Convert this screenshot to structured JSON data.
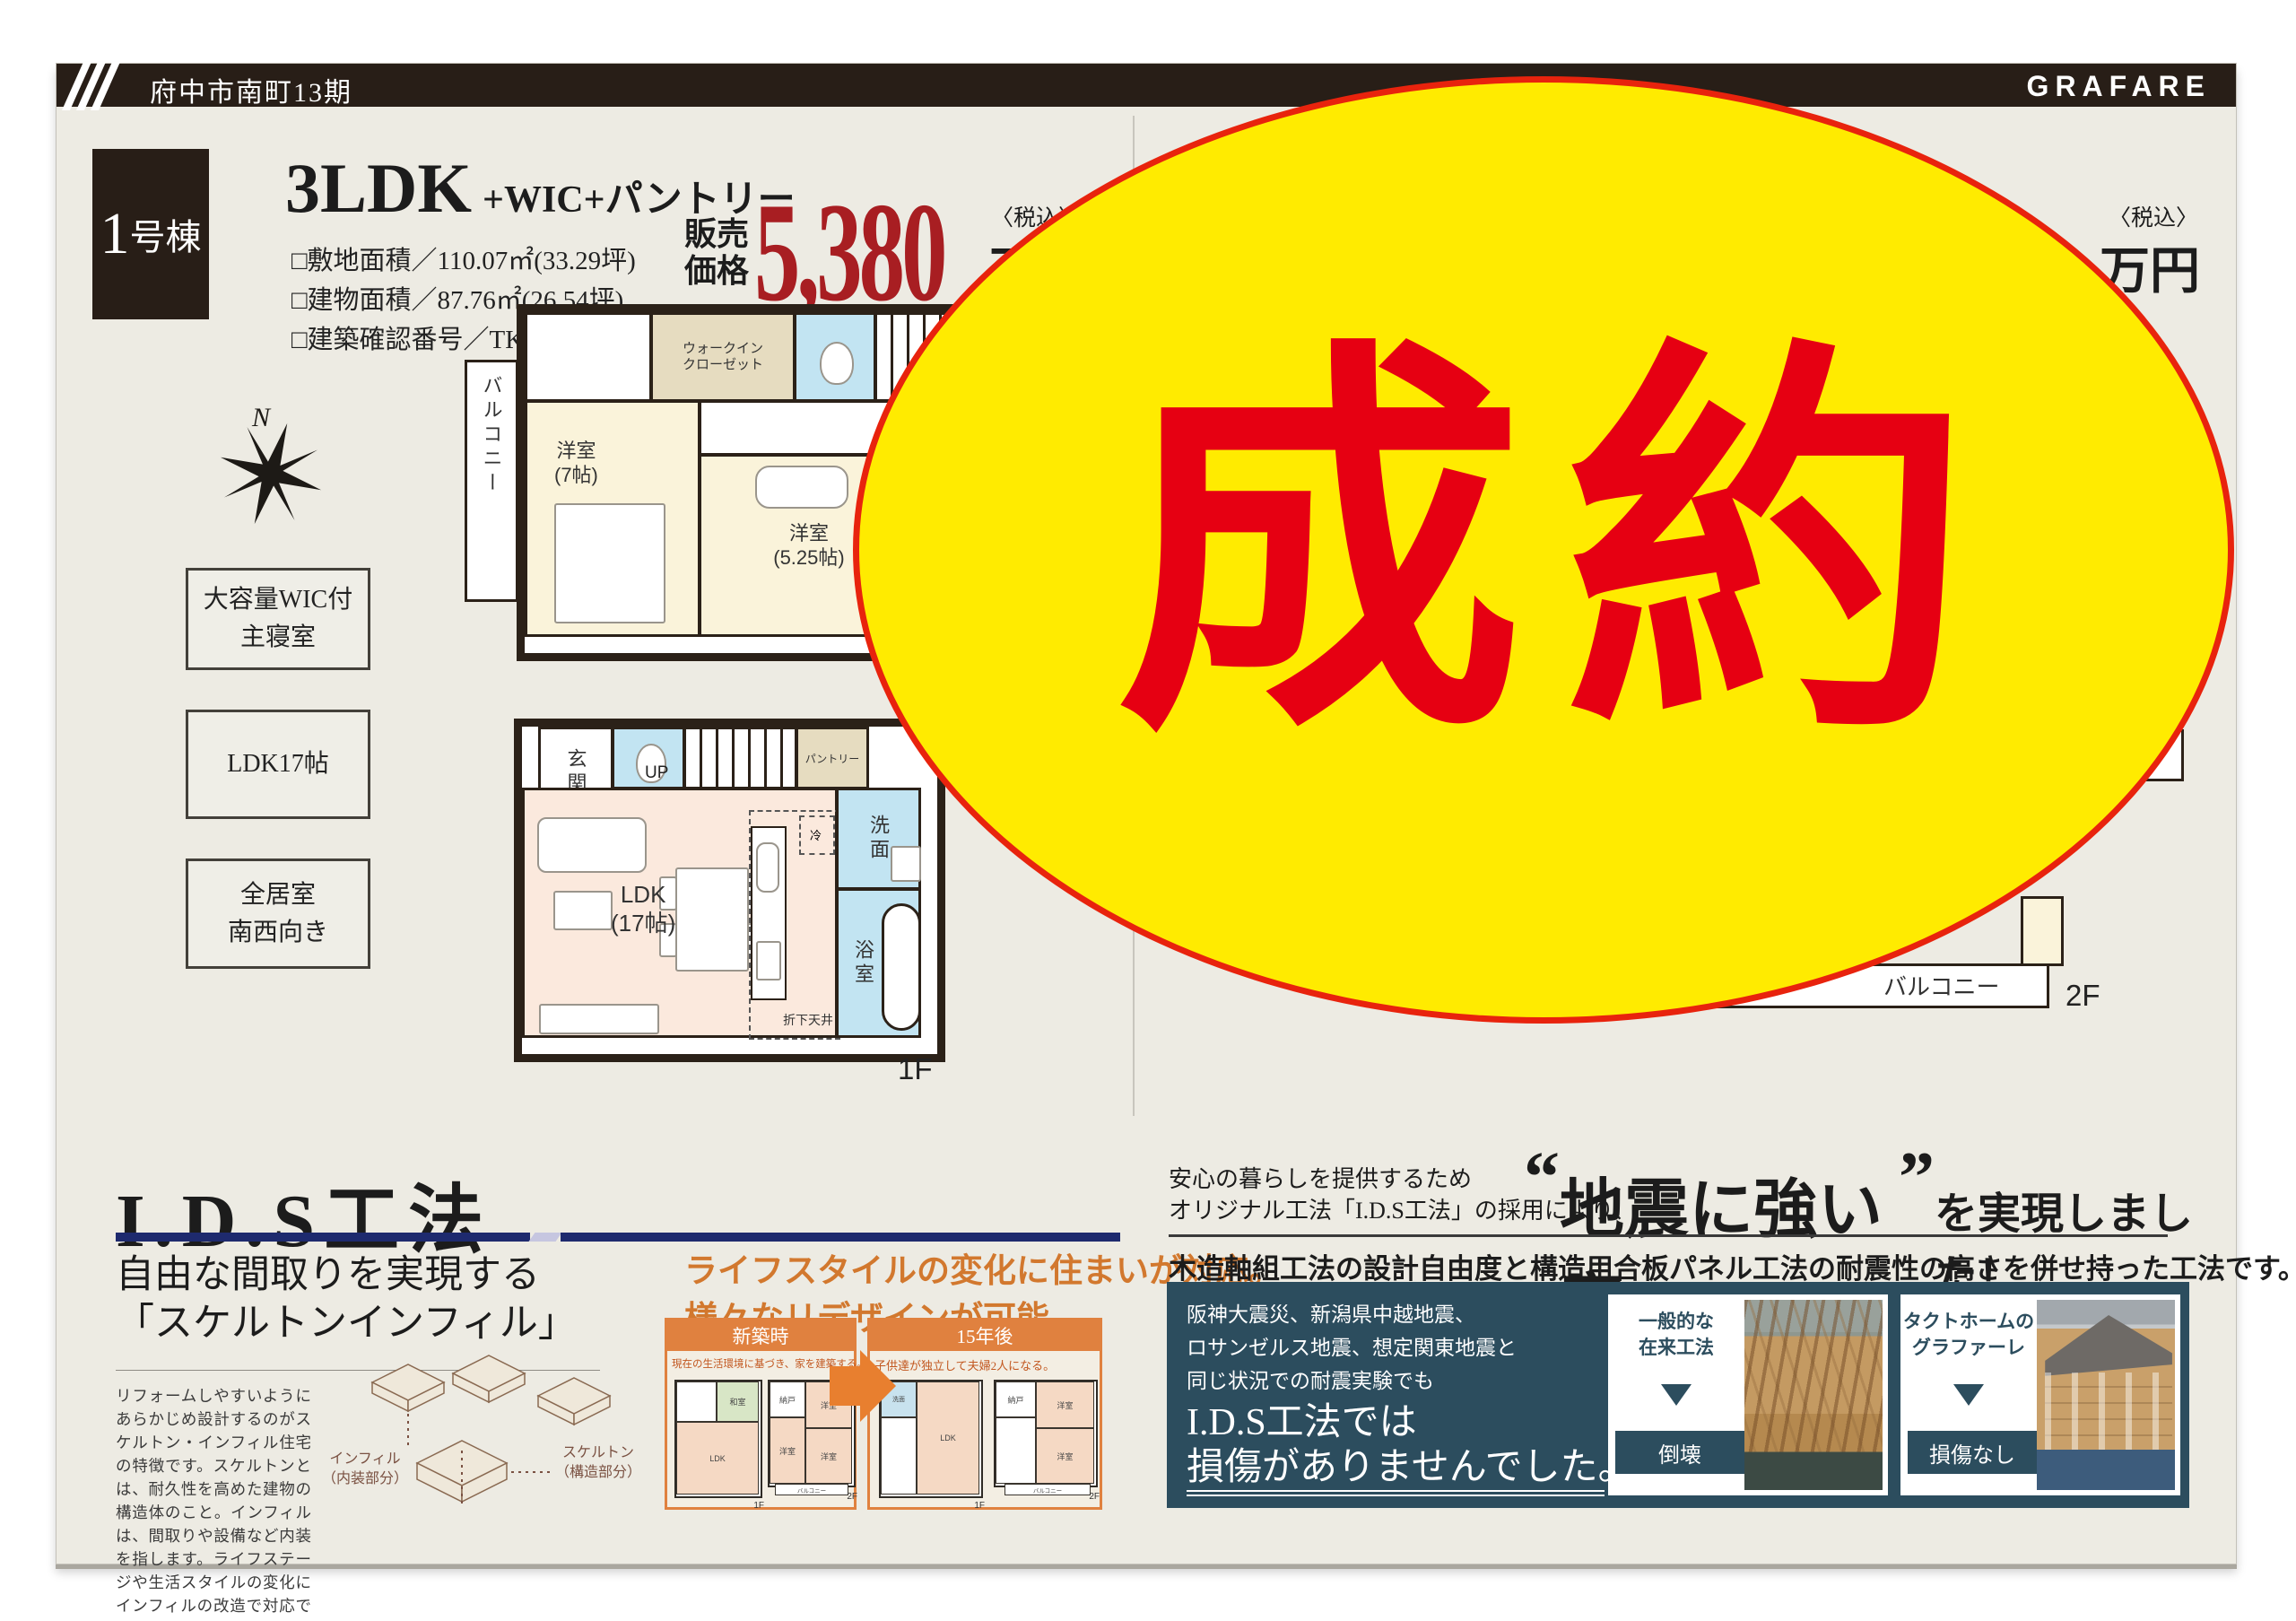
{
  "header": {
    "project": "府中市南町13期",
    "brand": "GRAFARE"
  },
  "unit1": {
    "badge_num": "1",
    "badge_suffix": "号棟",
    "plan": "3LDK",
    "plan_suffix": "+WIC+パントリー",
    "specs": [
      "□敷地面積／110.07㎡(33.29坪)",
      "□建物面積／87.76㎡(26.54坪)",
      "□建築確認番号／TKK確済25-244号"
    ],
    "price": {
      "label1": "販売",
      "label2": "価格",
      "value": "5,380",
      "tax": "〈税込〉",
      "unit": "万円"
    },
    "features": [
      {
        "l1": "大容量WIC付",
        "l2": "主寝室"
      },
      {
        "l1": "LDK17帖",
        "l2": ""
      },
      {
        "l1": "全居室",
        "l2": "南西向き"
      }
    ],
    "compass_n": "N",
    "f2": {
      "wic1": "ウォークイン",
      "wic2": "クローゼット",
      "balcony": "バルコニー",
      "r1a": "洋室",
      "r1b": "(7帖)",
      "r2a": "洋室",
      "r2b": "(5.25帖)",
      "r3a": "洋室",
      "r3b": "(4.5帖)",
      "dn": "DN",
      "floor": "2F"
    },
    "f1": {
      "genkan": "玄関",
      "up": "UP",
      "pantry": "パントリー",
      "ldk1": "LDK",
      "ldk2": "(17帖)",
      "wash": "洗面",
      "bath": "浴室",
      "ceiling": "折下天井",
      "fridge": "冷",
      "floor": "1F"
    }
  },
  "unit3": {
    "badge_num": "3",
    "badge_suffix": "号棟",
    "plan": "3LDK",
    "plan_suffix": "+WIC×2+",
    "specs": [
      "□敷地面積／109.97㎡(33.",
      "□建物面積／86.94㎡(2",
      "□建築確認番号／T"
    ],
    "price": {
      "partial": "0",
      "tax": "〈税込〉",
      "unit": "万円"
    },
    "compass_n": "N",
    "f1": {
      "bath": "浴室",
      "wash": "洗面",
      "ds": "DS",
      "ceiling": "折下天井",
      "fridge": "冷",
      "ldk1": "LDK",
      "ldk2": "(16.5帖)",
      "floor": "1F"
    },
    "f2": {
      "balcony": "バルコニー",
      "floor": "2F"
    },
    "sold": "成約"
  },
  "ids": {
    "title": "I.D.S工法",
    "sub1": "自由な間取りを実現する",
    "sub2": "「スケルトンインフィル」",
    "body": "リフォームしやすいようにあらかじめ設計するのがスケルトン・インフィル住宅の特徴です。スケルトンとは、耐久性を高めた建物の構造体のこと。インフィルは、間取りや設備など内装を指します。ライフステージや生活スタイルの変化にインフィルの改造で対応できるため、スケルトン自体は長期的に有効活用することが可能になります。",
    "infill1": "インフィル",
    "infill2": "（内装部分）",
    "skeleton1": "スケルトン",
    "skeleton2": "（構造部分）"
  },
  "mid": {
    "head1": "ライフスタイルの変化に住まいが対応。",
    "head2": "様々なリデザインが可能。",
    "box1": {
      "header": "新築時",
      "caption": "現在の生活環境に基づき、家を建築する。",
      "t1": [
        "和室",
        "LDK",
        "1F"
      ],
      "t2": [
        "納戸",
        "洋室",
        "洋室",
        "洋室",
        "バルコニー",
        "2F"
      ]
    },
    "box2": {
      "header": "15年後",
      "caption": "子供達が独立して夫婦2人になる。",
      "t1": [
        "洗面",
        "LDK",
        "1F"
      ],
      "t2": [
        "納戸",
        "洋室",
        "洋室",
        "バルコニー",
        "2F"
      ]
    }
  },
  "quake": {
    "intro1": "安心の暮らしを提供するため",
    "intro2": "オリジナル工法「I.D.S工法」の採用により、",
    "head_q1": "“",
    "head_main": "地震に強い家",
    "head_q2": "”",
    "head_rest": "を実現しました！",
    "sub": "木造軸組工法の設計自由度と構造用合板パネル工法の耐震性の高さを併せ持った工法です。",
    "lines": [
      "阪神大震災、新潟県中越地震、",
      "ロサンゼルス地震、想定関東地震と",
      "同じ状況での耐震実験でも"
    ],
    "big1": "I.D.S工法では",
    "big2": "損傷がありませんでした。",
    "card1": {
      "l1": "一般的な",
      "l2": "在来工法",
      "result": "倒壊"
    },
    "card2": {
      "l1": "タクトホームの",
      "l2": "グラファーレ",
      "result": "損傷なし"
    }
  },
  "colors": {
    "header_brown": "#281e17",
    "price_red": "#a81e22",
    "sold_yellow": "#ffeb00",
    "sold_red": "#e60012",
    "orange": "#e0813f",
    "navy_bar": "#1e2a6e",
    "teal_box": "#2c4d5e"
  }
}
